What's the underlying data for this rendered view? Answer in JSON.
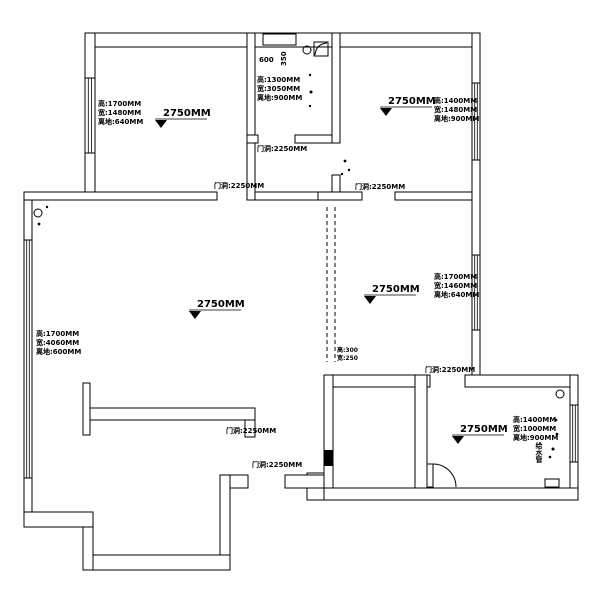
{
  "colors": {
    "line": "#000000",
    "background": "#ffffff"
  },
  "rooms": [
    {
      "name": "top-left-bedroom",
      "ceiling": "2750MM",
      "window": [
        "高:1700MM",
        "宽:1480MM",
        "离地:640MM"
      ]
    },
    {
      "name": "bathroom",
      "shaft_w": "600",
      "shaft_h": "350",
      "window": [
        "高:1300MM",
        "宽:3050MM",
        "离地:900MM"
      ]
    },
    {
      "name": "top-right-bedroom",
      "ceiling": "2750MM",
      "window": [
        "高:1400MM",
        "宽:1480MM",
        "离地:900MM"
      ]
    },
    {
      "name": "middle-right-room",
      "ceiling": "2750MM",
      "window": [
        "高:1700MM",
        "宽:1460MM",
        "离地:640MM"
      ]
    },
    {
      "name": "living-room",
      "ceiling": "2750MM",
      "window": [
        "高:1700MM",
        "宽:4060MM",
        "离地:600MM"
      ]
    },
    {
      "name": "bottom-right-room",
      "ceiling": "2750MM",
      "window": [
        "高:1400MM",
        "宽:1000MM",
        "离地:900MM"
      ]
    }
  ],
  "doors": [
    "门洞:2250MM",
    "门洞:2250MM",
    "门洞:2250MM",
    "门洞:2250MM",
    "门洞:2250MM",
    "门洞:2250MM"
  ],
  "beam": [
    "高:300",
    "宽:250"
  ],
  "pipe_label": "给水管"
}
